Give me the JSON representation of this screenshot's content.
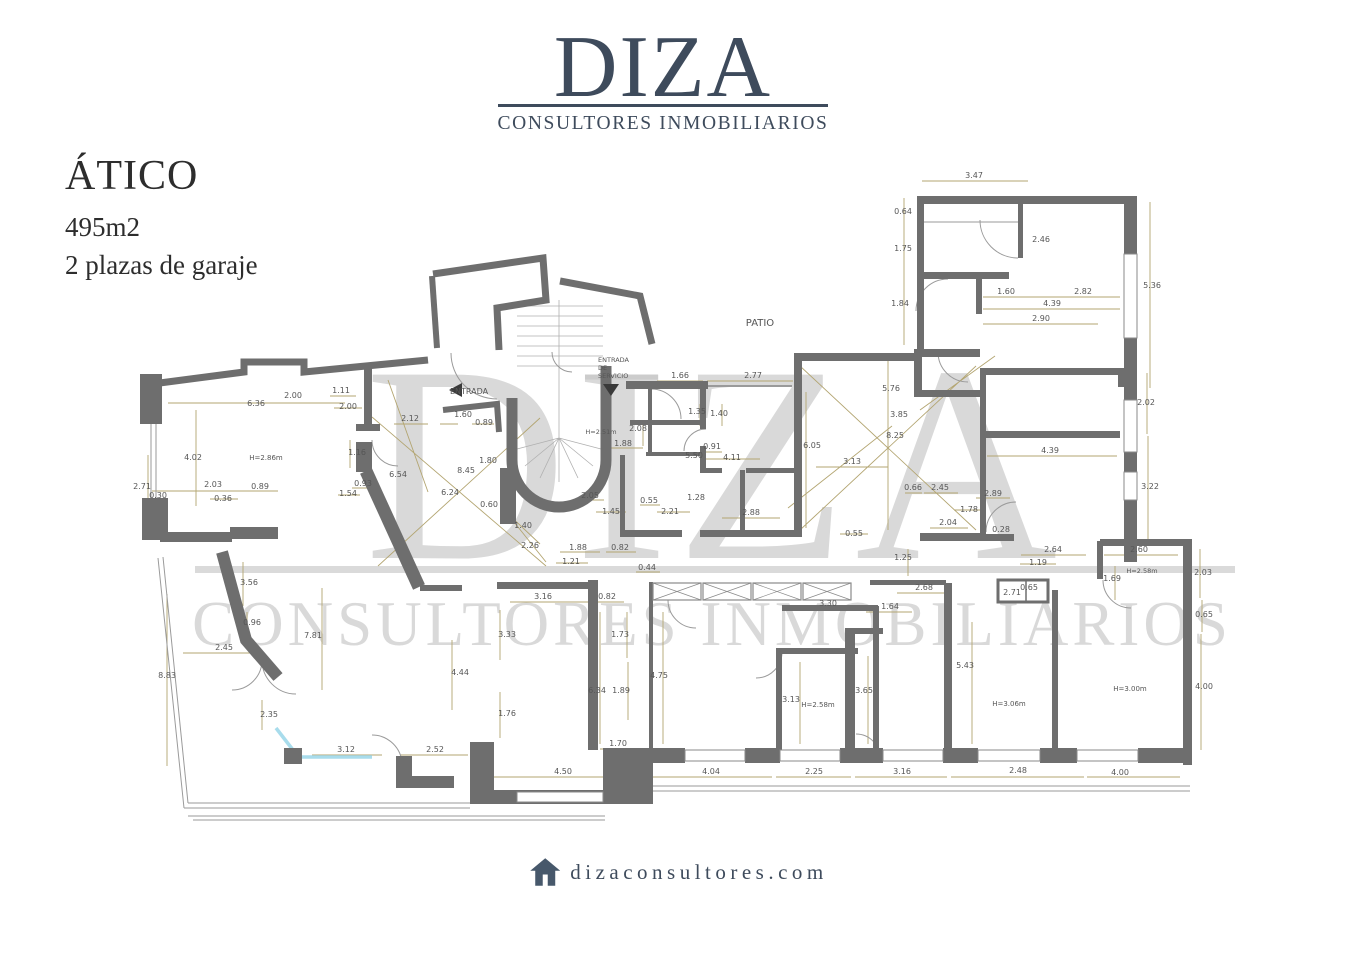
{
  "header": {
    "brand": "DIZA",
    "tagline": "CONSULTORES INMOBILIARIOS",
    "color": "#3e4b5c"
  },
  "listing": {
    "title": "ÁTICO",
    "area": "495m2",
    "parking": "2 plazas de garaje"
  },
  "watermark": {
    "brand": "DIZA",
    "tagline": "CONSULTORES INMOBILIARIOS",
    "color": "#d9d9d9"
  },
  "footer": {
    "url": "dizaconsultores.com",
    "icon": "house-icon"
  },
  "floorplan": {
    "colors": {
      "wall": "#6e6e6e",
      "dimension_line": "#b3a571",
      "dimension_text": "#565656",
      "glass": "#a8dcec"
    },
    "labels": [
      {
        "t": "PATIO",
        "x": 760,
        "y": 326,
        "s": 10,
        "n": "room-label-patio"
      },
      {
        "t": "ENTRADA",
        "x": 469,
        "y": 394,
        "s": 8,
        "n": "room-label-entrada"
      },
      {
        "t": "ENTRADA",
        "x": 598,
        "y": 362,
        "s": 6.5,
        "a": "start",
        "n": "room-label-entrada-servicio"
      },
      {
        "t": "DE",
        "x": 598,
        "y": 370,
        "s": 6.5,
        "a": "start",
        "n": "room-label-entrada-servicio"
      },
      {
        "t": "SERVICIO",
        "x": 598,
        "y": 378,
        "s": 6.5,
        "a": "start",
        "n": "room-label-entrada-servicio"
      },
      {
        "t": "H=2.86m",
        "x": 266,
        "y": 460,
        "s": 7,
        "n": "height-label"
      },
      {
        "t": "H=2.51m",
        "x": 601,
        "y": 434,
        "s": 6.5,
        "n": "height-label"
      },
      {
        "t": "H=2.58m",
        "x": 818,
        "y": 707,
        "s": 7,
        "n": "height-label"
      },
      {
        "t": "H=2.58m",
        "x": 1142,
        "y": 573,
        "s": 6.5,
        "n": "height-label"
      },
      {
        "t": "H=3.06m",
        "x": 1009,
        "y": 706,
        "s": 7,
        "n": "height-label"
      },
      {
        "t": "H=3.00m",
        "x": 1130,
        "y": 691,
        "s": 7,
        "n": "height-label"
      },
      {
        "t": "3.47",
        "x": 974,
        "y": 178
      },
      {
        "t": "0.64",
        "x": 903,
        "y": 214
      },
      {
        "t": "1.75",
        "x": 903,
        "y": 251
      },
      {
        "t": "1.84",
        "x": 900,
        "y": 306
      },
      {
        "t": "2.46",
        "x": 1041,
        "y": 242
      },
      {
        "t": "1.60",
        "x": 1006,
        "y": 294
      },
      {
        "t": "2.82",
        "x": 1083,
        "y": 294
      },
      {
        "t": "4.39",
        "x": 1052,
        "y": 306
      },
      {
        "t": "2.90",
        "x": 1041,
        "y": 321
      },
      {
        "t": "5.36",
        "x": 1152,
        "y": 288
      },
      {
        "t": "2.02",
        "x": 1146,
        "y": 405
      },
      {
        "t": "3.22",
        "x": 1150,
        "y": 489
      },
      {
        "t": "4.39",
        "x": 1050,
        "y": 453
      },
      {
        "t": "1.66",
        "x": 680,
        "y": 378
      },
      {
        "t": "2.77",
        "x": 753,
        "y": 378
      },
      {
        "t": "1.35",
        "x": 697,
        "y": 414
      },
      {
        "t": "1.40",
        "x": 719,
        "y": 416
      },
      {
        "t": "5.76",
        "x": 891,
        "y": 391
      },
      {
        "t": "3.85",
        "x": 899,
        "y": 417
      },
      {
        "t": "8.25",
        "x": 895,
        "y": 438
      },
      {
        "t": "6.05",
        "x": 812,
        "y": 448
      },
      {
        "t": "3.13",
        "x": 852,
        "y": 464
      },
      {
        "t": "0.91",
        "x": 712,
        "y": 449
      },
      {
        "t": "5.50",
        "x": 694,
        "y": 458
      },
      {
        "t": "4.11",
        "x": 732,
        "y": 460
      },
      {
        "t": "2.08",
        "x": 638,
        "y": 431
      },
      {
        "t": "1.88",
        "x": 623,
        "y": 446
      },
      {
        "t": "2.05",
        "x": 590,
        "y": 498
      },
      {
        "t": "1.45",
        "x": 611,
        "y": 514
      },
      {
        "t": "0.55",
        "x": 649,
        "y": 503
      },
      {
        "t": "2.21",
        "x": 670,
        "y": 514
      },
      {
        "t": "1.28",
        "x": 696,
        "y": 500
      },
      {
        "t": "2.88",
        "x": 751,
        "y": 515
      },
      {
        "t": "0.55",
        "x": 854,
        "y": 536
      },
      {
        "t": "0.66",
        "x": 913,
        "y": 490
      },
      {
        "t": "2.45",
        "x": 940,
        "y": 490
      },
      {
        "t": "2.89",
        "x": 993,
        "y": 496
      },
      {
        "t": "1.78",
        "x": 969,
        "y": 512
      },
      {
        "t": "2.04",
        "x": 948,
        "y": 525
      },
      {
        "t": "0.28",
        "x": 1001,
        "y": 532
      },
      {
        "t": "6.36",
        "x": 256,
        "y": 406
      },
      {
        "t": "2.00",
        "x": 293,
        "y": 398
      },
      {
        "t": "1.11",
        "x": 341,
        "y": 393
      },
      {
        "t": "2.00",
        "x": 348,
        "y": 409
      },
      {
        "t": "2.12",
        "x": 410,
        "y": 421
      },
      {
        "t": "1.16",
        "x": 357,
        "y": 455
      },
      {
        "t": "4.02",
        "x": 193,
        "y": 460
      },
      {
        "t": "2.71",
        "x": 142,
        "y": 489
      },
      {
        "t": "0.30",
        "x": 158,
        "y": 498
      },
      {
        "t": "2.03",
        "x": 213,
        "y": 487
      },
      {
        "t": "0.36",
        "x": 223,
        "y": 501
      },
      {
        "t": "0.89",
        "x": 260,
        "y": 489
      },
      {
        "t": "0.93",
        "x": 363,
        "y": 486
      },
      {
        "t": "1.54",
        "x": 348,
        "y": 496
      },
      {
        "t": "6.54",
        "x": 398,
        "y": 477
      },
      {
        "t": "1.60",
        "x": 463,
        "y": 417
      },
      {
        "t": "0.89",
        "x": 484,
        "y": 425
      },
      {
        "t": "8.45",
        "x": 466,
        "y": 473
      },
      {
        "t": "1.80",
        "x": 488,
        "y": 463
      },
      {
        "t": "6.24",
        "x": 450,
        "y": 495
      },
      {
        "t": "0.60",
        "x": 489,
        "y": 507
      },
      {
        "t": "1.40",
        "x": 523,
        "y": 528
      },
      {
        "t": "2.26",
        "x": 530,
        "y": 548
      },
      {
        "t": "1.88",
        "x": 578,
        "y": 550
      },
      {
        "t": "1.21",
        "x": 571,
        "y": 564
      },
      {
        "t": "0.82",
        "x": 620,
        "y": 550
      },
      {
        "t": "0.44",
        "x": 647,
        "y": 570
      },
      {
        "t": "3.16",
        "x": 543,
        "y": 599
      },
      {
        "t": "0.82",
        "x": 607,
        "y": 599
      },
      {
        "t": "3.33",
        "x": 507,
        "y": 637
      },
      {
        "t": "1.73",
        "x": 620,
        "y": 637
      },
      {
        "t": "4.44",
        "x": 460,
        "y": 675
      },
      {
        "t": "6.34",
        "x": 597,
        "y": 693
      },
      {
        "t": "1.89",
        "x": 621,
        "y": 693
      },
      {
        "t": "4.75",
        "x": 659,
        "y": 678
      },
      {
        "t": "1.76",
        "x": 507,
        "y": 716
      },
      {
        "t": "2.52",
        "x": 435,
        "y": 752
      },
      {
        "t": "1.70",
        "x": 618,
        "y": 746
      },
      {
        "t": "4.50",
        "x": 563,
        "y": 774
      },
      {
        "t": "4.04",
        "x": 711,
        "y": 774
      },
      {
        "t": "2.25",
        "x": 814,
        "y": 774
      },
      {
        "t": "3.16",
        "x": 902,
        "y": 774
      },
      {
        "t": "2.48",
        "x": 1018,
        "y": 773
      },
      {
        "t": "4.00",
        "x": 1120,
        "y": 775
      },
      {
        "t": "3.56",
        "x": 249,
        "y": 585
      },
      {
        "t": "0.96",
        "x": 252,
        "y": 625
      },
      {
        "t": "7.81",
        "x": 313,
        "y": 638
      },
      {
        "t": "2.45",
        "x": 224,
        "y": 650
      },
      {
        "t": "8.83",
        "x": 167,
        "y": 678
      },
      {
        "t": "2.35",
        "x": 269,
        "y": 717
      },
      {
        "t": "3.12",
        "x": 346,
        "y": 752
      },
      {
        "t": "3.30",
        "x": 828,
        "y": 606
      },
      {
        "t": "1.64",
        "x": 890,
        "y": 609
      },
      {
        "t": "1.25",
        "x": 903,
        "y": 560
      },
      {
        "t": "2.68",
        "x": 924,
        "y": 590
      },
      {
        "t": "2.71",
        "x": 1012,
        "y": 595
      },
      {
        "t": "0.65",
        "x": 1029,
        "y": 590
      },
      {
        "t": "1.69",
        "x": 1112,
        "y": 581
      },
      {
        "t": "2.64",
        "x": 1053,
        "y": 552
      },
      {
        "t": "2.60",
        "x": 1139,
        "y": 552
      },
      {
        "t": "1.19",
        "x": 1038,
        "y": 565
      },
      {
        "t": "2.03",
        "x": 1203,
        "y": 575
      },
      {
        "t": "0.65",
        "x": 1204,
        "y": 617
      },
      {
        "t": "5.43",
        "x": 965,
        "y": 668
      },
      {
        "t": "4.00",
        "x": 1204,
        "y": 689
      },
      {
        "t": "3.13",
        "x": 791,
        "y": 702
      },
      {
        "t": "3.65",
        "x": 864,
        "y": 693
      }
    ]
  }
}
